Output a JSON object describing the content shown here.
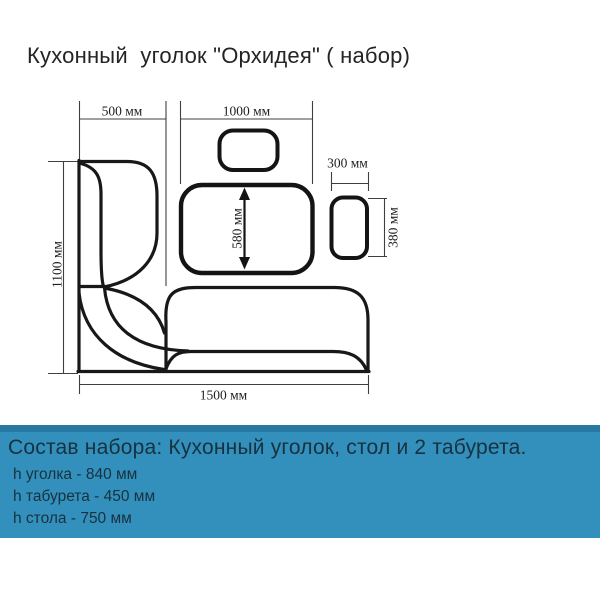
{
  "title": "Кухонный  уголок \"Орхидея\" ( набор)",
  "diagram": {
    "dims": {
      "d500": "500 мм",
      "d1000": "1000 мм",
      "d300": "300 мм",
      "d380": "380 мм",
      "d1100": "1100 мм",
      "d580": "580 мм",
      "d1500": "1500 мм"
    }
  },
  "banner": {
    "heading": "Состав набора: Кухонный уголок, стол и 2 табурета.",
    "items": [
      "h уголка - 840 мм",
      "h табурета - 450 мм",
      "h стола - 750 мм"
    ]
  },
  "colors": {
    "banner_bg": "#338fbb",
    "banner_top_strip": "#2878a2",
    "banner_text": "#17323f",
    "drawing_line": "#181818"
  }
}
